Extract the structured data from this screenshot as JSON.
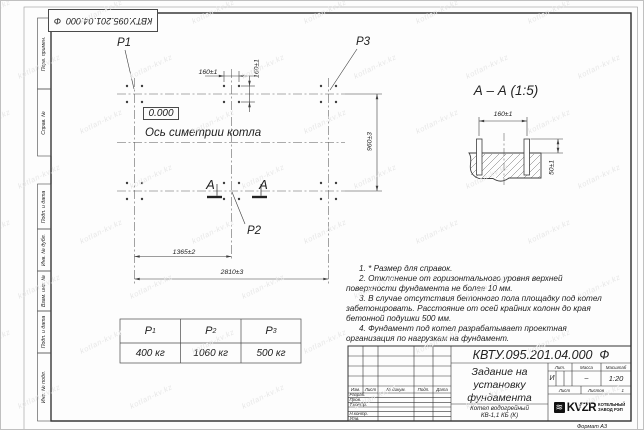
{
  "watermark": {
    "text": "kotlan-kv.kz"
  },
  "margin": {
    "labels": [
      "Перв. примен.",
      "Справ. №",
      "Подп. и дата",
      "Инв. № дубл.",
      "Взам. инв. №",
      "Подп. и дата",
      "Инв. № подл."
    ]
  },
  "plan": {
    "p1": "P1",
    "p2": "P2",
    "p3": "P3",
    "level_mark": "0.000",
    "symmetry_axis_label": "Ось симетрии котла",
    "section_letter": "А",
    "dims": {
      "bolt_spacing_x": "160±1",
      "bolt_spacing_y": "160±1",
      "row_spacing": "960±3",
      "mid_span": "1365±2",
      "full_span": "2810±3"
    }
  },
  "section_view": {
    "title": "А – А (1:5)",
    "dims": {
      "bolt_spacing": "160±1",
      "bolt_protrusion": "50±1"
    }
  },
  "notes": [
    "1. * Размер для справок.",
    "2. Отклонение от горизонтального уровня верхней поверхности фундамента не более 10 мм.",
    "3. В случае отсутствия бетонного пола площадку под котел забетонировать. Расстояние от осей крайних колонн до края бетонной подушки 500 мм.",
    "4. Фундамент под котел разрабатывает проектная организация по нагрузкам на фундамент."
  ],
  "load_table": {
    "columns": [
      {
        "label": "P",
        "sub": "1",
        "value": "400 кг"
      },
      {
        "label": "P",
        "sub": "2",
        "value": "1060 кг"
      },
      {
        "label": "P",
        "sub": "3",
        "value": "500 кг"
      }
    ]
  },
  "title_block": {
    "doc_number": "КВТУ.095.201.04.000  Ф",
    "title_lines": [
      "Задание на",
      "установку",
      "фундамента"
    ],
    "product_lines": [
      "Котел водогрейный",
      "КВ-1,1 КБ (К)"
    ],
    "header_cols": [
      "Изм.",
      "Лист",
      "№ докум.",
      "Подп.",
      "Дата"
    ],
    "sign_labels": [
      "Разраб.",
      "Пров.",
      "Т.контр.",
      "Н.контр.",
      "Утв."
    ],
    "lit_header": "Лит.",
    "mass_header": "Масса",
    "scale_header": "Масштаб",
    "lit_value": "И",
    "mass_value": "–",
    "scale_value": "1:20",
    "sheet_label": "Лист",
    "sheets_label": "Листов",
    "sheets_value": "1",
    "logo_icon": "≋",
    "logo_text": "KVZR",
    "logo_caption_lines": [
      "КОТЕЛЬНЫЙ",
      "ЗАВОД РЭП"
    ],
    "format_label": "Формат А3"
  }
}
